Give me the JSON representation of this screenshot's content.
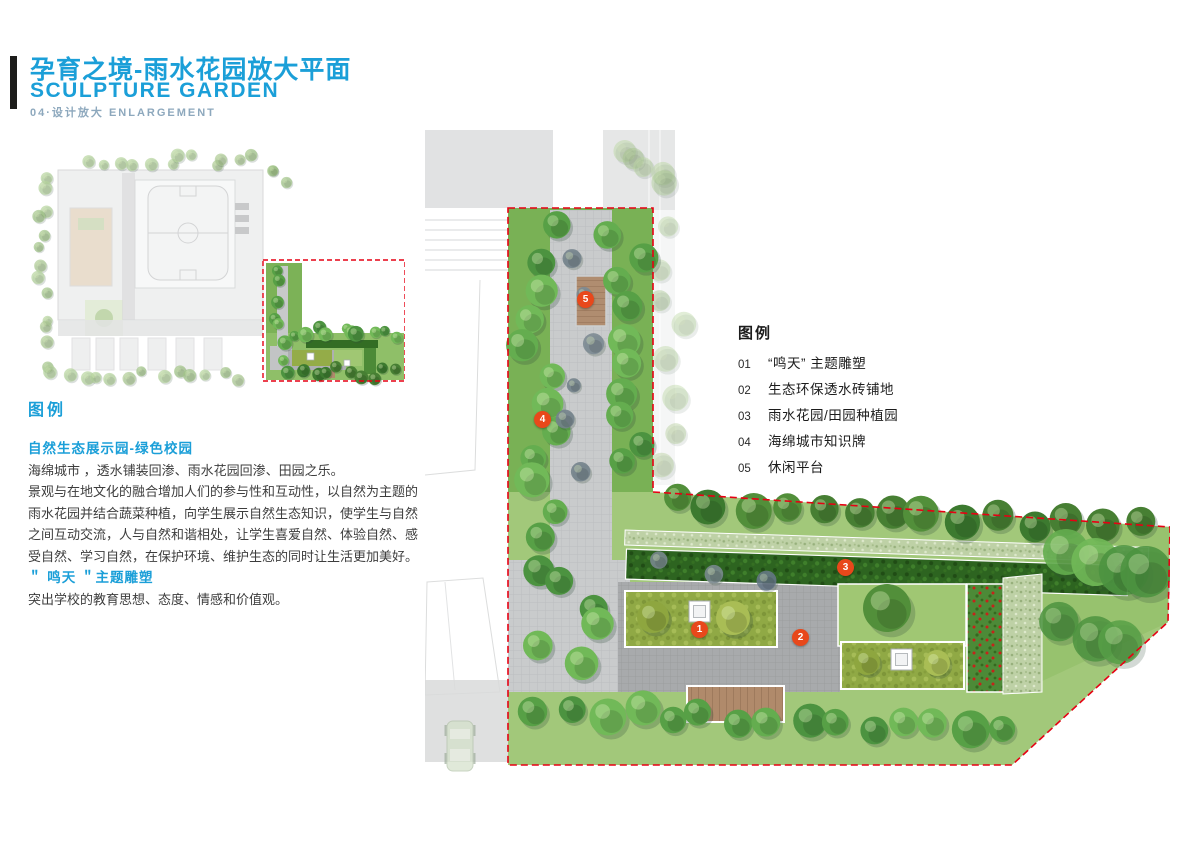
{
  "header": {
    "title_cn": "孕育之境-雨水花园放大平面",
    "title_en": "SCULPTURE GARDEN",
    "subtitle": "04·设计放大  ENLARGEMENT"
  },
  "left_panel": {
    "legend_heading": "图例",
    "section_title": "自然生态展示园-绿色校园",
    "para1": "海绵城市 ，透水铺装回渗、雨水花园回渗、田园之乐。",
    "para2": "景观与在地文化的融合增加人们的参与性和互动性，以自然为主题的雨水花园并结合蔬菜种植，向学生展示自然生态知识，使学生与自然之间互动交流，人与自然和谐相处，让学生喜爱自然、体验自然、感受自然、学习自然，在保护环境、维护生态的同时让生活更加美好。",
    "sub_title": "＂ 鸣天 ＂主题雕塑",
    "para3": "突出学校的教育思想、态度、情感和价值观。"
  },
  "plan_legend": {
    "heading": "图例",
    "items": [
      {
        "num": "01",
        "label": "“鸣天” 主题雕塑"
      },
      {
        "num": "02",
        "label": "生态环保透水砖铺地"
      },
      {
        "num": "03",
        "label": "雨水花园/田园种植园"
      },
      {
        "num": "04",
        "label": "海绵城市知识牌"
      },
      {
        "num": "05",
        "label": "休闲平台"
      }
    ]
  },
  "plan": {
    "markers": [
      {
        "num": "1"
      },
      {
        "num": "2"
      },
      {
        "num": "3"
      },
      {
        "num": "4"
      },
      {
        "num": "5"
      }
    ]
  },
  "colors": {
    "accent_blue": "#1b9fd8",
    "subtitle_blue_gray": "#8da8bd",
    "marker_red": "#e8481b",
    "boundary_dash_red": "#e60113",
    "title_bar_black": "#1d1d1b"
  }
}
